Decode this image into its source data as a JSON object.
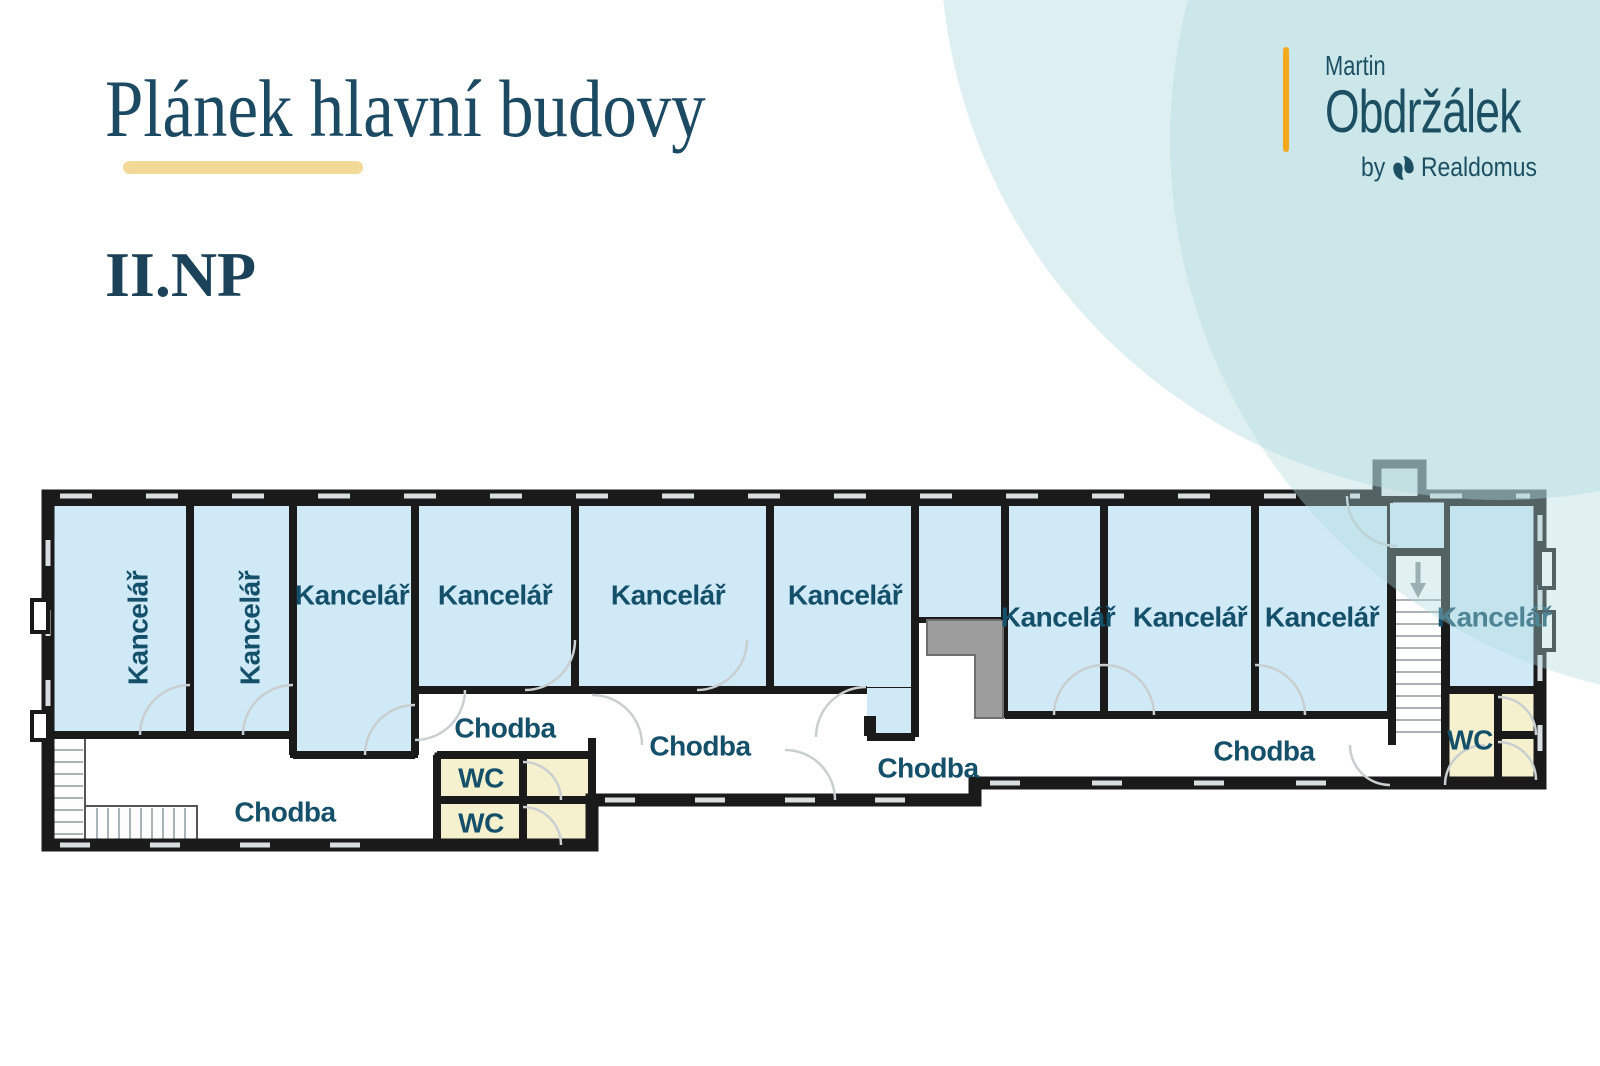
{
  "header": {
    "title": "Plánek hlavní budovy",
    "floor": "II.NP"
  },
  "logo": {
    "name_line1": "Martin",
    "name_line2": "Obdržálek",
    "by": "by",
    "brand": "Realdomus"
  },
  "plan": {
    "office_label": "Kancelář",
    "corridor_label": "Chodba",
    "wc_label": "WC",
    "rooms": [
      {
        "type": "office",
        "label": "Kancelář"
      },
      {
        "type": "office",
        "label": "Kancelář"
      },
      {
        "type": "office",
        "label": "Kancelář"
      },
      {
        "type": "office",
        "label": "Kancelář"
      },
      {
        "type": "office",
        "label": "Kancelář"
      },
      {
        "type": "office",
        "label": "Kancelář"
      },
      {
        "type": "office",
        "label": "Kancelář"
      },
      {
        "type": "office",
        "label": "Kancelář"
      },
      {
        "type": "office",
        "label": "Kancelář"
      },
      {
        "type": "office",
        "label": "Kancelář"
      },
      {
        "type": "corridor",
        "label": "Chodba"
      },
      {
        "type": "corridor",
        "label": "Chodba"
      },
      {
        "type": "corridor",
        "label": "Chodba"
      },
      {
        "type": "corridor",
        "label": "Chodba"
      },
      {
        "type": "corridor",
        "label": "Chodba"
      },
      {
        "type": "wc",
        "label": "WC"
      },
      {
        "type": "wc",
        "label": "WC"
      },
      {
        "type": "wc",
        "label": "WC"
      }
    ]
  },
  "colors": {
    "room_fill": "#cfe9f7",
    "wc_fill": "#f5f1cf",
    "wall": "#1a1a1a",
    "label_text": "#14506a",
    "title_text": "#1c4a63",
    "accent_gold": "#f3d998",
    "logo_yellow": "#f2a91e",
    "logo_teal": "#1d4f63",
    "mint_decor": "#b0d9dd"
  }
}
